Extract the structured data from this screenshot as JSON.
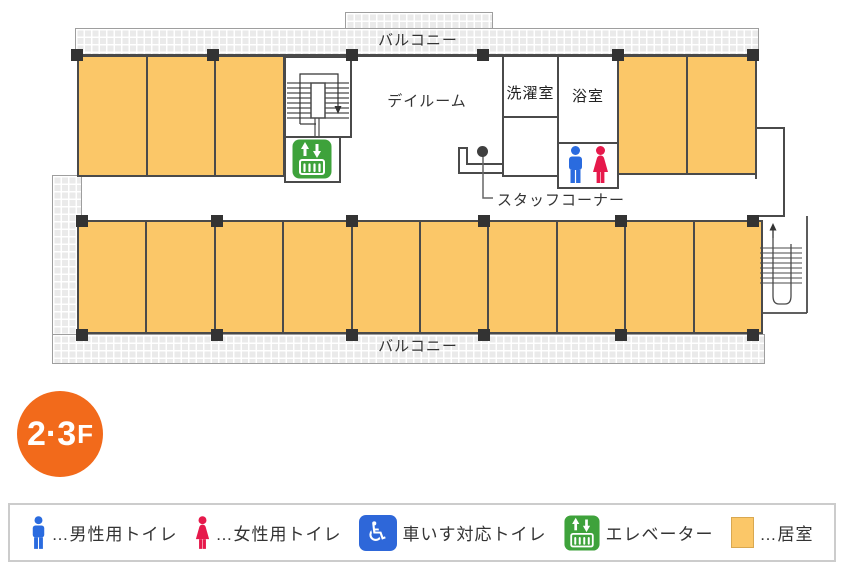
{
  "floor_plan": {
    "balcony_top": "バルコニー",
    "balcony_bottom": "バルコニー",
    "dayroom": "デイルーム",
    "laundry": "洗濯室",
    "bath": "浴室",
    "staff_corner": "スタッフコーナー",
    "rooms": {
      "top_left_count": 3,
      "top_right_count": 2,
      "bottom_count": 10
    }
  },
  "floor_badge": {
    "floors": "2·3",
    "suffix": "F"
  },
  "legend": {
    "items": [
      {
        "icon": "male-toilet-icon",
        "label": "…男性用トイレ"
      },
      {
        "icon": "female-toilet-icon",
        "label": "…女性用トイレ"
      },
      {
        "icon": "wheelchair-toilet-icon",
        "label": "車いす対応トイレ"
      },
      {
        "icon": "elevator-icon",
        "label": "エレベーター"
      },
      {
        "icon": "living-room-swatch",
        "label": "…居室"
      }
    ]
  },
  "icons": {
    "wheelchair_glyph": "♿"
  },
  "colors": {
    "room_fill": "#FBC768",
    "room_border": "#4A4A4A",
    "wall": "#4A4A4A",
    "balcony_fill": "#EAEAEA",
    "balcony_border": "#9E9E9E",
    "pillar": "#333333",
    "elevator_green": "#3EA23B",
    "male_blue": "#2A6BDF",
    "female_red": "#E6194B",
    "wheelchair_blue": "#2E67D9",
    "badge_orange": "#F26A1B",
    "legend_border": "#CCCCCC",
    "swatch_border": "#D9A850"
  }
}
